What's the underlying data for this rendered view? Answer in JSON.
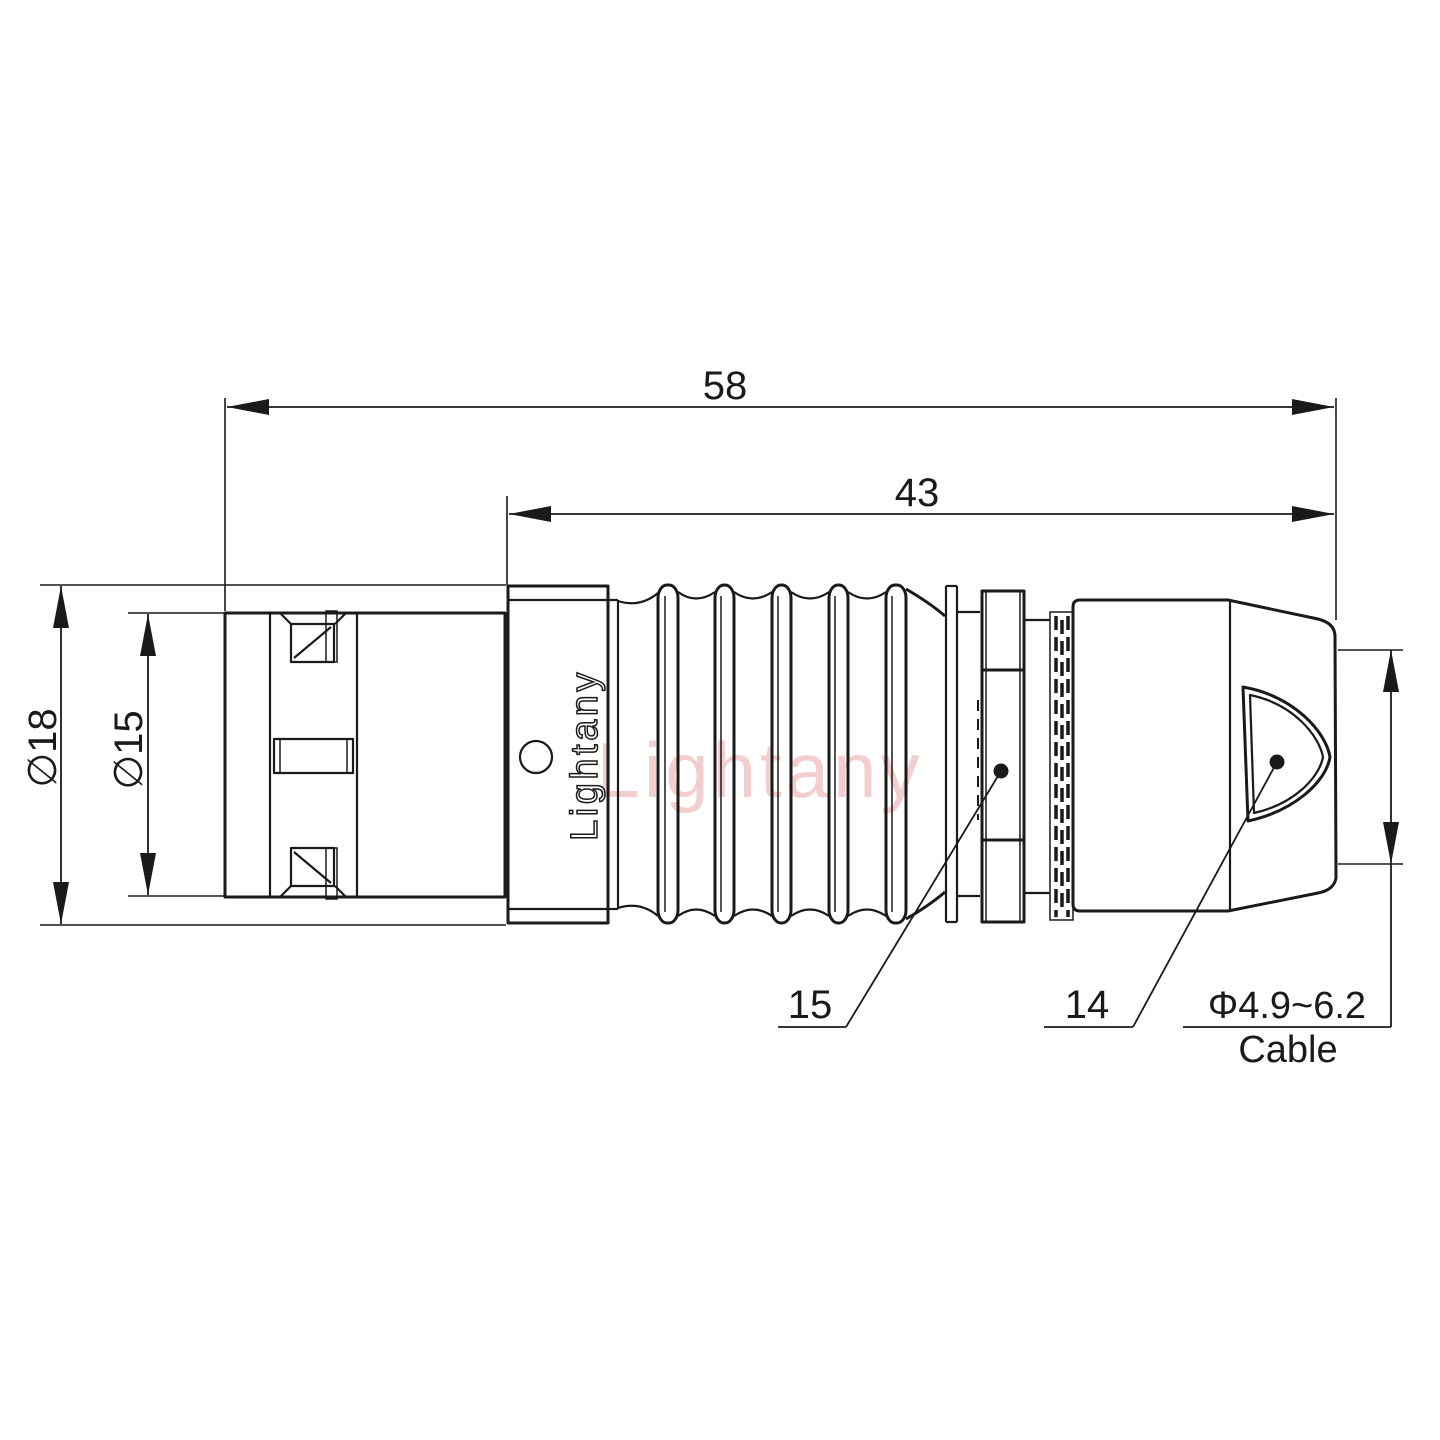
{
  "drawing": {
    "watermark": "Lightany",
    "logo": "Lightany",
    "dimensions": {
      "overall_length": "58",
      "body_length": "43",
      "outer_diameter": "∅18",
      "front_diameter": "∅15",
      "cable_range": "Φ4.9~6.2",
      "cable_label": "Cable"
    },
    "part_labels": {
      "nut": "15",
      "boot": "14"
    },
    "colors": {
      "line": "#1a1a1a",
      "watermark": "#e89f9f",
      "background": "#ffffff"
    }
  }
}
